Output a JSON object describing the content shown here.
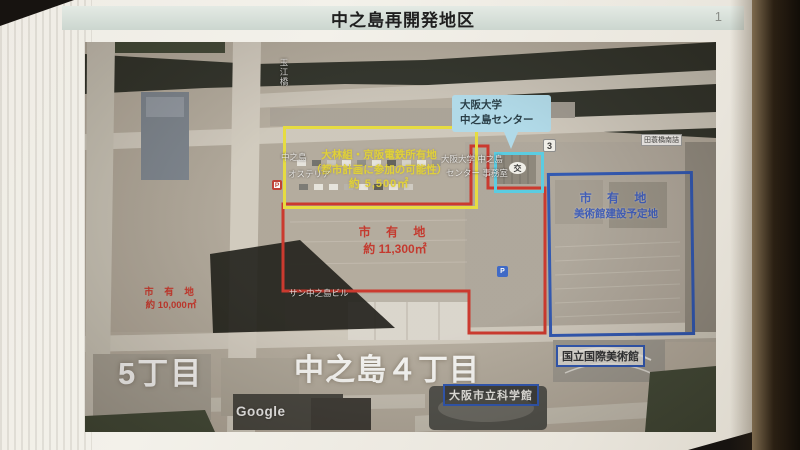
{
  "header": {
    "title": "中之島再開発地区",
    "page_number": "1"
  },
  "map": {
    "attribution": "Google",
    "district_labels": {
      "west": "5丁目",
      "main": "中之島４丁目"
    },
    "parcels": {
      "yellow": {
        "line1": "大林組・京阪電鉄所有地",
        "line2": "（都市計画に参加の可能性）",
        "line3": "約 5,500㎡",
        "color": "#ecdf1a"
      },
      "red_main": {
        "line1": "市 有 地",
        "line2": "約 11,300㎡",
        "color": "#d8271a"
      },
      "red_west": {
        "line1": "市 有 地",
        "line2": "約 10,000㎡",
        "color": "#d8271a"
      },
      "blue": {
        "line1": "市 有 地",
        "line2": "美術館建設予定地",
        "color": "#1d4fc2"
      }
    },
    "callout": {
      "line1": "大阪大学",
      "line2": "中之島センター",
      "bg_color": "#a8ddf1"
    },
    "landmark_labels": {
      "art_museum": "国立国際美術館",
      "science_museum": "大阪市立科学館"
    },
    "map_labels": {
      "nakanoshima": "中之島",
      "osteria": "オステリア",
      "handai_office_1": "大阪大学 中之島",
      "handai_office_2": "センター 事務室",
      "building": "サン中之島ビル",
      "bridge_vertical": "玉江橋",
      "intersection": "田蓑橋南詰"
    },
    "markers": {
      "route_number": "3",
      "koban": "交",
      "parking": "P"
    }
  }
}
